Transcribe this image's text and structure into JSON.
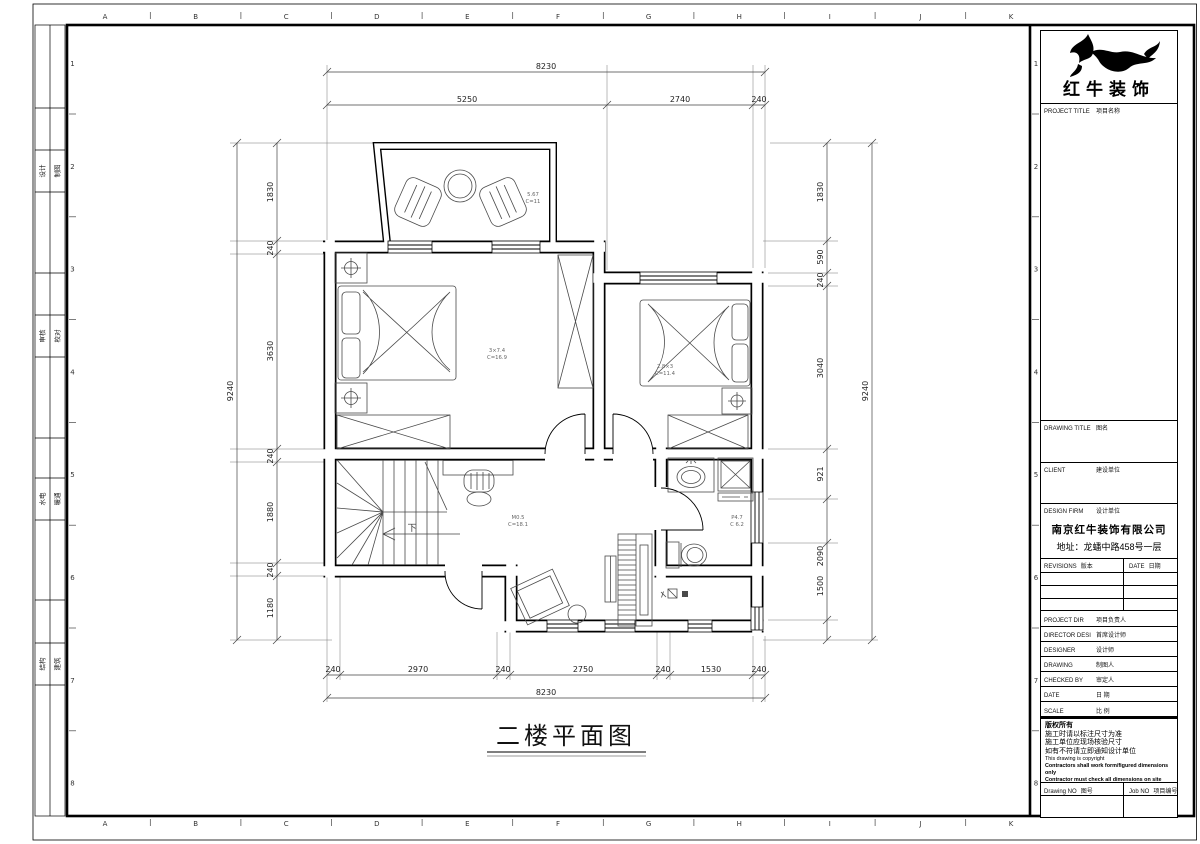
{
  "sheet": {
    "col_letters": [
      "A",
      "B",
      "C",
      "D",
      "E",
      "F",
      "G",
      "H",
      "I",
      "J",
      "K"
    ],
    "row_numbers": [
      "1",
      "2",
      "3",
      "4",
      "5",
      "6",
      "7",
      "8"
    ],
    "margin_stamps": [
      {
        "a": "设计",
        "b": "制图"
      },
      {
        "a": "审核",
        "b": "校对"
      },
      {
        "a": "水电",
        "b": "暖通"
      },
      {
        "a": "结构",
        "b": "建筑"
      }
    ]
  },
  "title_block": {
    "brand": "红牛装饰",
    "project_title": {
      "en": "PROJECT TITLE",
      "zh": "项目名称"
    },
    "drawing_title": {
      "en": "DRAWING TITLE",
      "zh": "图名"
    },
    "client": {
      "en": "CLIENT",
      "zh": "建设单位"
    },
    "design_firm": {
      "en": "DESIGN FIRM",
      "zh": "设计单位"
    },
    "firm_name": "南京红牛装饰有限公司",
    "firm_address": "地址：龙蟠中路458号一层",
    "revisions": {
      "en": "REVISIONS",
      "zh": "版本"
    },
    "date_col": {
      "en": "DATE",
      "zh": "日期"
    },
    "rows": [
      {
        "en": "PROJECT DIR",
        "zh": "项目负责人"
      },
      {
        "en": "DIRECTOR DESI",
        "zh": "首席设计师"
      },
      {
        "en": "DESIGNER",
        "zh": "设计师"
      },
      {
        "en": "DRAWING",
        "zh": "制图人"
      },
      {
        "en": "CHECKED BY",
        "zh": "审定人"
      },
      {
        "en": "DATE",
        "zh": "日 期"
      },
      {
        "en": "SCALE",
        "zh": "比 例"
      }
    ],
    "notes_zh": [
      "版权所有",
      "施工时请以标注尺寸为准",
      "施工单位应现场核验尺寸",
      "如有不符请立即通知设计单位"
    ],
    "notes_en": [
      "This drawing is copyright",
      "Contractors shall work form/figured dimensions only",
      "Contractor must check all dimensions on site",
      "Contractors must be reported immediately to architects"
    ],
    "drawing_no": {
      "en": "Drawing NO",
      "zh": "图号"
    },
    "job_no": {
      "en": "Job NO",
      "zh": "项目编号"
    }
  },
  "plan": {
    "title": "二楼平面图",
    "stair_label": "下",
    "dims": {
      "top_overall": "8230",
      "top_chain": [
        "5250",
        "2740",
        "240"
      ],
      "bottom_chain": [
        "240",
        "2970",
        "240",
        "2750",
        "240",
        "1530",
        "240"
      ],
      "bottom_overall": "8230",
      "left_overall": "9240",
      "left_chain": [
        "1830",
        "240",
        "3630",
        "240",
        "1880",
        "240",
        "1180"
      ],
      "right_chain": [
        "1830",
        "590",
        "240",
        "3040",
        "921",
        "2090",
        "1500"
      ],
      "right_overall": "9240"
    },
    "room_labels": [
      {
        "l1": "5.67",
        "l2": "C=11"
      },
      {
        "l1": "3×7.4",
        "l2": "C=16.9"
      },
      {
        "l1": "2.8×3",
        "l2": "C=11.4"
      },
      {
        "l1": "M0.5",
        "l2": "C=18.1"
      },
      {
        "l1": "P4.7",
        "l2": "C 6.2"
      }
    ]
  }
}
